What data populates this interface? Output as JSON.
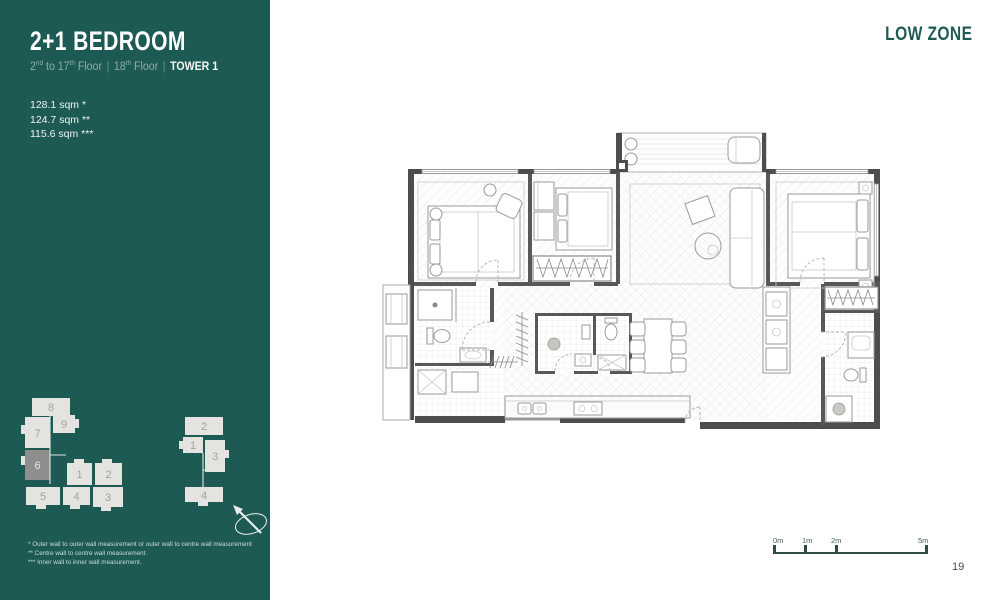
{
  "header": {
    "title": "2+1 BEDROOM",
    "zone": "LOW ZONE",
    "subtitle": {
      "range_base": "2",
      "range_sup": "nd",
      "range_mid": " to 17",
      "range_mid_sup": "th",
      "range_tail": " Floor",
      "sep1": "|",
      "floor18_base": "18",
      "floor18_sup": "th",
      "floor18_tail": " Floor",
      "sep2": "|",
      "tower": "TOWER 1"
    }
  },
  "areas": [
    "128.1 sqm *",
    "124.7 sqm **",
    "115.6 sqm ***"
  ],
  "keyplan": {
    "tower1": {
      "units": [
        "1",
        "2",
        "3",
        "4",
        "5",
        "6",
        "7",
        "8",
        "9"
      ],
      "highlighted_unit": "6"
    },
    "tower2": {
      "units": [
        "1",
        "2",
        "3",
        "4"
      ]
    }
  },
  "footnotes": [
    "* Outer wall to outer wall measurement or outer wall to centre wall measurement",
    "** Centre wall to centre wall measurement.",
    "*** Inner wall to inner wall measurement."
  ],
  "scalebar": {
    "labels": [
      "0m",
      "1m",
      "2m",
      "5m"
    ]
  },
  "page_number": "19",
  "colors": {
    "panel": "#1E5A54",
    "accent": "#1E5A54",
    "keyplan_block": "#E4E3DF",
    "keyplan_highlight": "#8E8E8C",
    "wall": "#4D4D4D"
  }
}
